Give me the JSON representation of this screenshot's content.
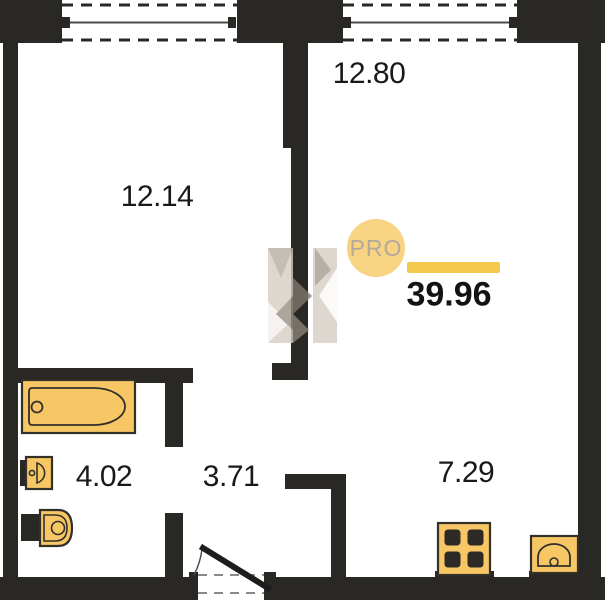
{
  "total_area": "39.96",
  "badge_label": "PRO",
  "rooms": [
    {
      "value": "12.14"
    },
    {
      "value": "12.80"
    },
    {
      "value": "4.02"
    },
    {
      "value": "3.71"
    },
    {
      "value": "7.29"
    }
  ],
  "colors": {
    "wall": "#2a2825",
    "fixture_fill": "#f7c766",
    "fixture_stroke": "#33302a",
    "accent_bar": "#f2c84d",
    "badge_fill": "#f7d382",
    "badge_text": "#b3aa9d"
  }
}
